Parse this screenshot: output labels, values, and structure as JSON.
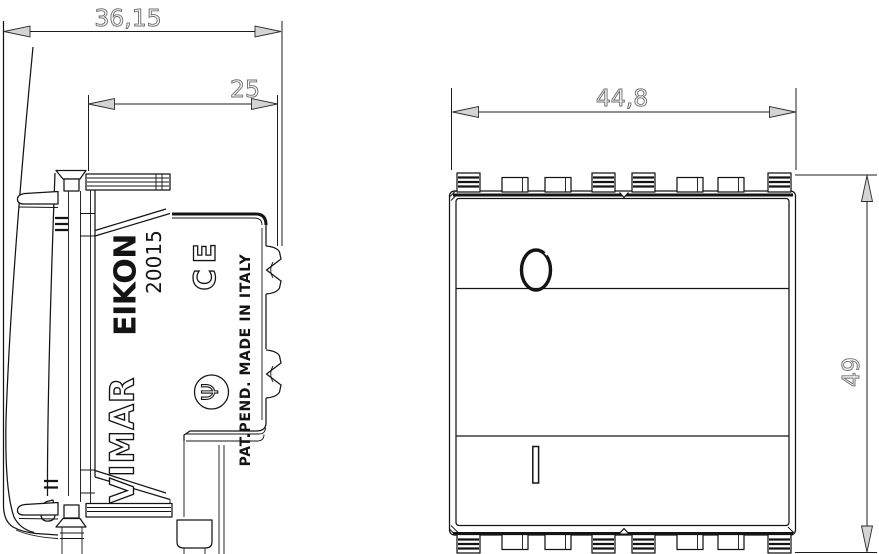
{
  "side_view": {
    "brand": "VIMAR",
    "series": "EIKON",
    "model": "20015",
    "ce_mark": "CE",
    "cert_symbol": "Ψ",
    "patent_text": "PAT.PEND. MADE IN ITALY",
    "dims": {
      "total_depth": "36,15",
      "body_depth": "25"
    }
  },
  "front_view": {
    "dims": {
      "width": "44,8",
      "height": "49"
    },
    "markings": {
      "off": "0",
      "on": "I"
    }
  },
  "colors": {
    "line": "#141414",
    "background": "#ffffff",
    "arrow_fill": "#d4d4d4",
    "dim_text_fill": "#fdfdfd",
    "dim_text_outline": "#6f6f6f"
  }
}
